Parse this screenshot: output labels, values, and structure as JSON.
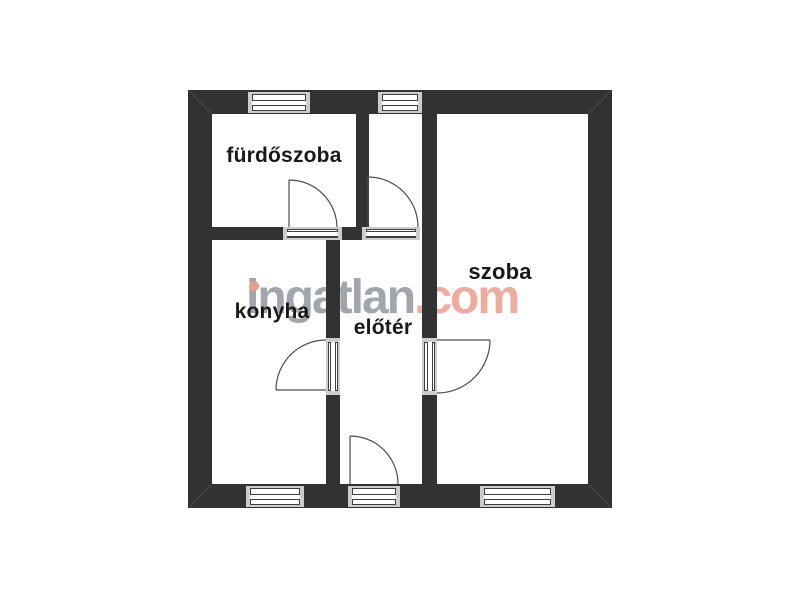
{
  "plan": {
    "type": "apartment-floor-plan",
    "rooms": [
      {
        "id": "furdoszoba",
        "label": "fürdőszoba"
      },
      {
        "id": "konyha",
        "label": "konyha"
      },
      {
        "id": "eloter",
        "label": "előtér"
      },
      {
        "id": "szoba",
        "label": "szoba"
      }
    ]
  },
  "watermark": {
    "name": "ingatlan",
    "tld": ".com",
    "gray_color": "#a1a5ac",
    "accent_color": "#eeab9e"
  },
  "colors": {
    "background": "#ffffff",
    "wall": "#323232",
    "window_sill": "#cdcdcd",
    "window_frame": "#3e3e3e",
    "door_swing_line": "#4d4d4d",
    "label_text": "#191919"
  }
}
